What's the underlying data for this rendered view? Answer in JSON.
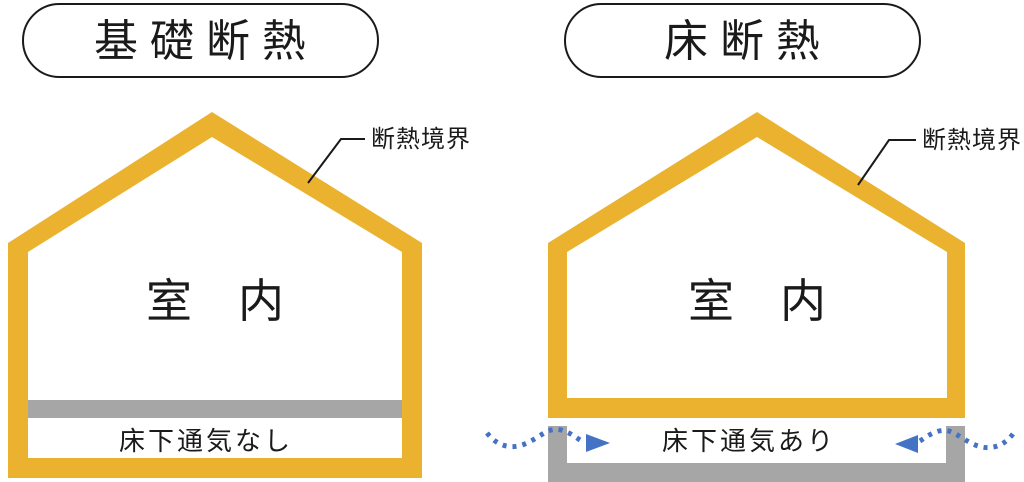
{
  "colors": {
    "insulation_yellow": "#EAB22F",
    "concrete_gray": "#A6A6A6",
    "airflow_blue": "#4472C4",
    "line_black": "#1A1A1A"
  },
  "left_diagram": {
    "title": "基礎断熱",
    "boundary_label": "断熱境界",
    "interior_label": "室　内",
    "floor_note": "床下通気なし"
  },
  "right_diagram": {
    "title": "床断熱",
    "boundary_label": "断熱境界",
    "interior_label": "室　内",
    "floor_note": "床下通気あり"
  }
}
